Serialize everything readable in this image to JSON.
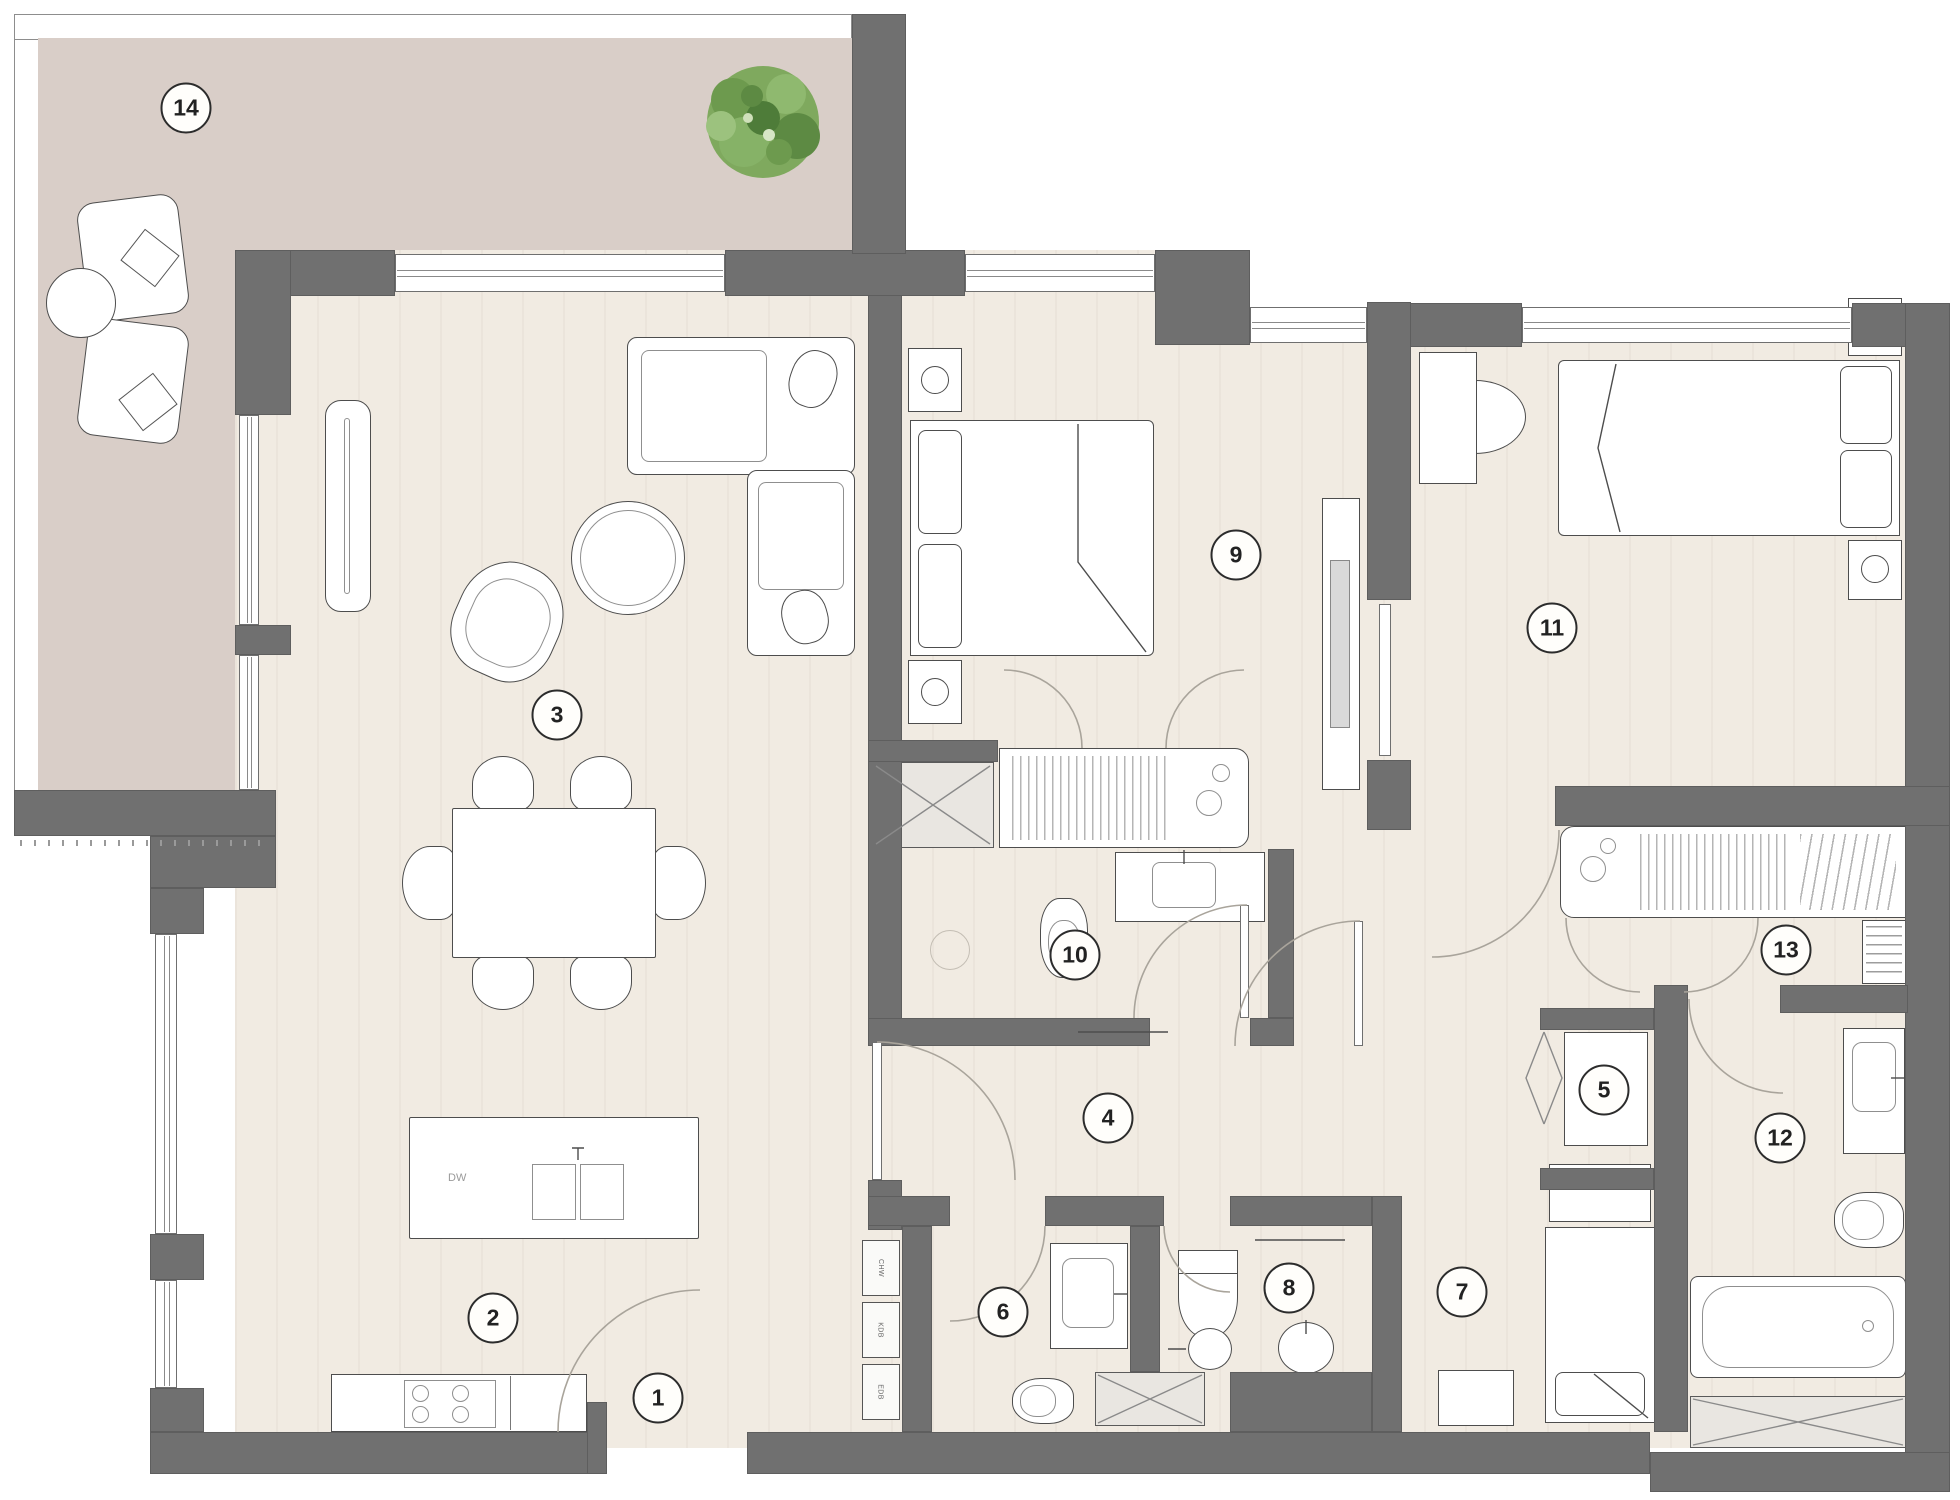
{
  "plan_title": "apartment-floor-plan",
  "rooms": [
    {
      "number": "1"
    },
    {
      "number": "2"
    },
    {
      "number": "3"
    },
    {
      "number": "4"
    },
    {
      "number": "5"
    },
    {
      "number": "6"
    },
    {
      "number": "7"
    },
    {
      "number": "8"
    },
    {
      "number": "9"
    },
    {
      "number": "10"
    },
    {
      "number": "11"
    },
    {
      "number": "12"
    },
    {
      "number": "13"
    },
    {
      "number": "14"
    }
  ],
  "labels": {
    "dishwasher": "DW",
    "utility_boxes": [
      "CHW",
      "KDB",
      "EDB"
    ]
  },
  "colors": {
    "wall": "#707070",
    "floor": "#f1ebe2",
    "terrace_floor": "#d9cec8",
    "plant_green": "#7fa95e"
  }
}
